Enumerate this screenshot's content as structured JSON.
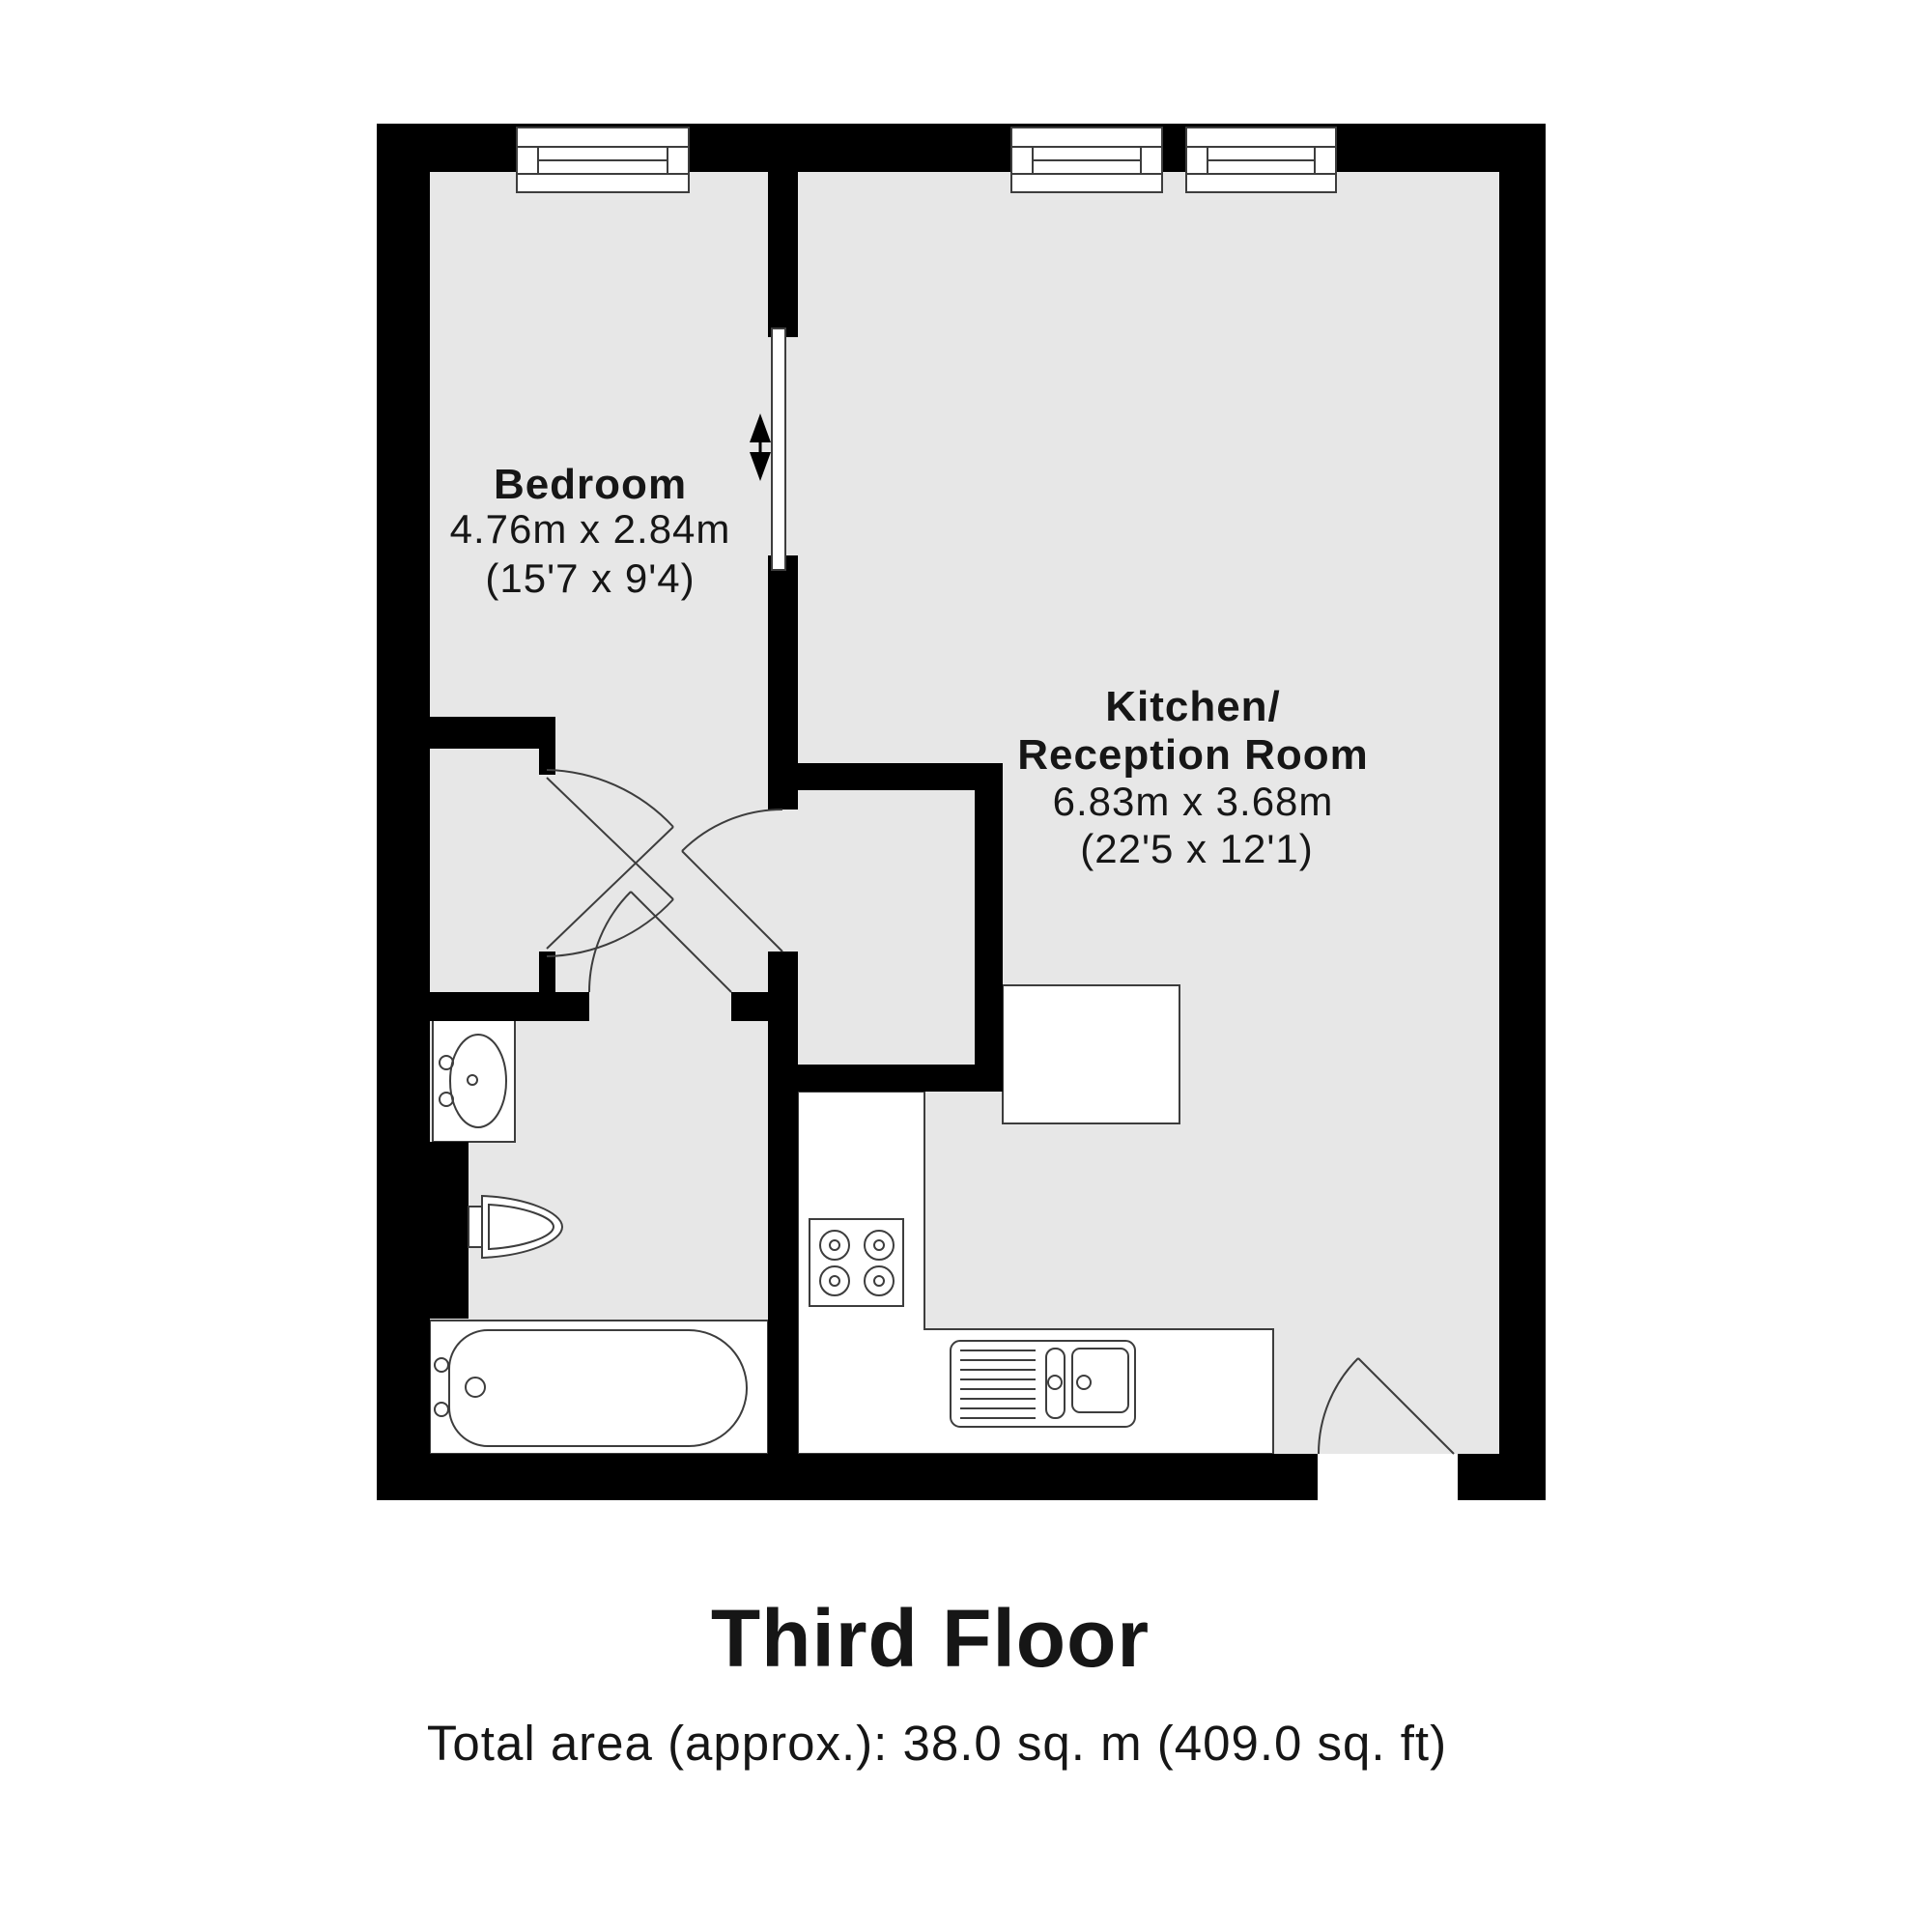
{
  "plan": {
    "rooms": [
      {
        "id": "bedroom",
        "name": "Bedroom",
        "dim_metric": "4.76m x 2.84m",
        "dim_imperial": "(15'7 x 9'4)"
      },
      {
        "id": "kitchen-reception",
        "name_line1": "Kitchen/",
        "name_line2": "Reception Room",
        "dim_metric": "6.83m x 3.68m",
        "dim_imperial": "(22'5 x 12'1)"
      }
    ],
    "fixtures": [
      "window",
      "sliding-door",
      "wardrobe-double-door",
      "bathroom-door",
      "storage-door",
      "entrance-door",
      "basin-vanity",
      "toilet",
      "bathtub",
      "hob",
      "kitchen-sink",
      "counter"
    ],
    "colors": {
      "wall": "#000000",
      "floor": "#e7e7e7",
      "fixture_outline": "#3d3d3d",
      "background": "#ffffff",
      "text": "#161616"
    }
  },
  "footer": {
    "title": "Third Floor",
    "total_area": "Total area (approx.): 38.0 sq. m (409.0 sq. ft)"
  }
}
